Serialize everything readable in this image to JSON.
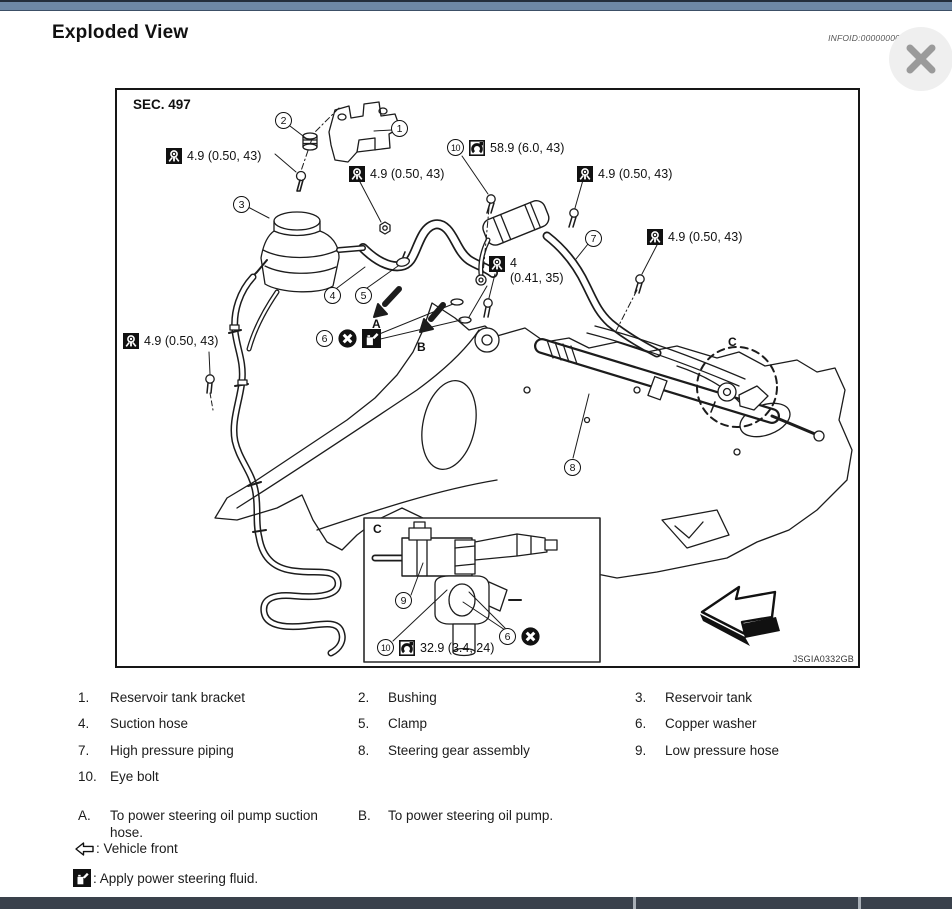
{
  "header": {
    "title": "Exploded View",
    "infoid": "INFOID:000000000"
  },
  "diagram": {
    "sec": "SEC. 497",
    "figure_id": "JSGIA0332GB",
    "torques": [
      {
        "value": "4.9 (0.50, 43)"
      },
      {
        "value": "4.9 (0.50, 43)"
      },
      {
        "value": "4.9 (0.50, 43)"
      },
      {
        "value": "4.9 (0.50, 43)"
      },
      {
        "value": "4.9 (0.50, 43)"
      },
      {
        "value": "4",
        "value2": "(0.41, 35)"
      }
    ],
    "eye_torques": [
      {
        "num": "10",
        "value": "58.9 (6.0, 43)"
      },
      {
        "num": "10",
        "value": "32.9 (3.4, 24)"
      }
    ],
    "callouts": [
      "2",
      "1",
      "3",
      "7",
      "4",
      "5",
      "6",
      "8",
      "9",
      "6"
    ],
    "letters": {
      "a": "A",
      "b": "B",
      "c": "C",
      "c_inset": "C"
    }
  },
  "legend": {
    "items": [
      {
        "num": "1.",
        "label": "Reservoir tank bracket"
      },
      {
        "num": "2.",
        "label": "Bushing"
      },
      {
        "num": "3.",
        "label": "Reservoir tank"
      },
      {
        "num": "4.",
        "label": "Suction hose"
      },
      {
        "num": "5.",
        "label": "Clamp"
      },
      {
        "num": "6.",
        "label": "Copper washer"
      },
      {
        "num": "7.",
        "label": "High pressure piping"
      },
      {
        "num": "8.",
        "label": "Steering gear assembly"
      },
      {
        "num": "9.",
        "label": "Low pressure hose"
      },
      {
        "num": "10.",
        "label": "Eye bolt"
      }
    ],
    "refs": [
      {
        "num": "A.",
        "label": "To power steering oil pump suction hose."
      },
      {
        "num": "B.",
        "label": "To power steering oil pump."
      }
    ]
  },
  "notes": {
    "vehicle_front": ": Vehicle front",
    "apply_fluid": ": Apply power steering fluid."
  }
}
